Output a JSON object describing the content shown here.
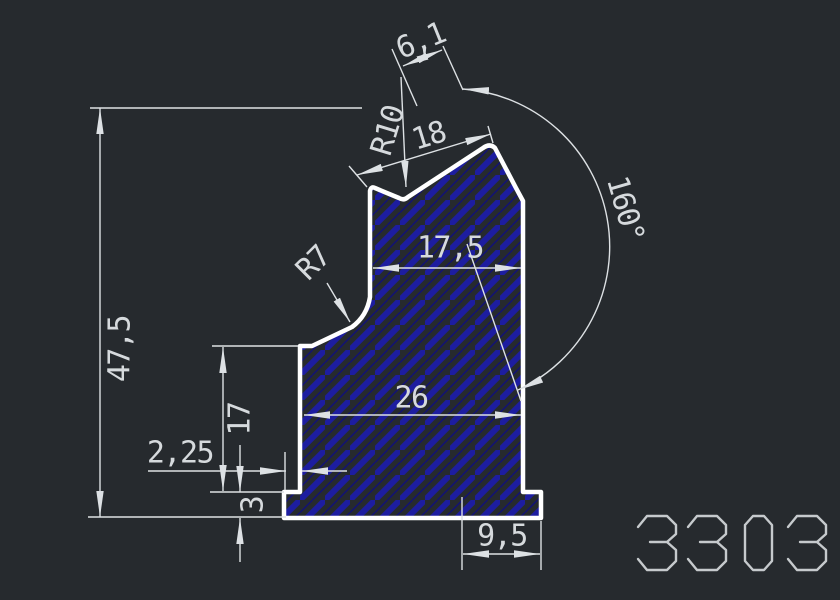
{
  "drawing": {
    "part_number": "3303",
    "dimensions": {
      "total_height": "47,5",
      "lower_height": "17",
      "base_thickness": "3",
      "left_offset": "2,25",
      "body_width": "26",
      "upper_width": "17,5",
      "base_right_width": "9,5",
      "top_width": "18",
      "notch_width": "6,1",
      "top_radius": "R10",
      "left_radius": "R7",
      "right_angle": "160°"
    },
    "colors": {
      "background": "#262a2e",
      "profile_outline": "#ffffff",
      "hatch": "#1d1da0",
      "dimension": "#dde1e4",
      "part_number_text": "#c6cacd"
    }
  }
}
